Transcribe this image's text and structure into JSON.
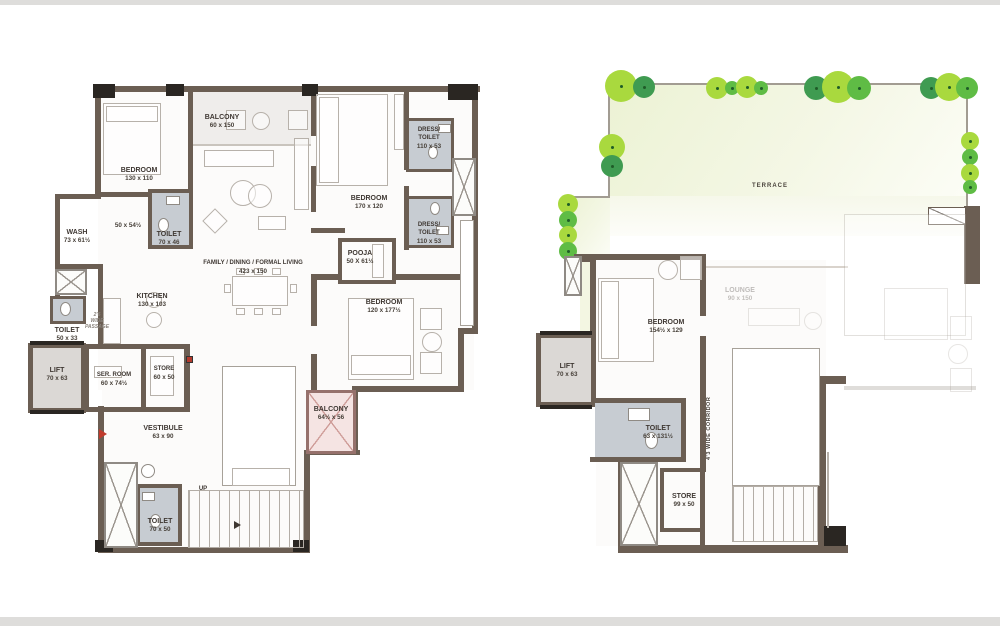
{
  "colors": {
    "wall": "#6b5e53",
    "toilet_fill": "#c7ccd2",
    "terrace_fill": "#eef3d8",
    "balcony_fill": "#f5e4e3",
    "lift_fill": "#dbd8d5",
    "tree_light": "#a9d93e",
    "tree_mid": "#5fbc45",
    "tree_dark": "#3f9b51",
    "label_text": "#3f3833",
    "entry_arrow": "#c03b2d"
  },
  "left": {
    "balcony_top": {
      "name": "BALCONY",
      "dims": "60 x 150"
    },
    "bedroom1": {
      "name": "BEDROOM",
      "dims": "130 x 110"
    },
    "bedroom2": {
      "name": "BEDROOM",
      "dims": "170 x 120"
    },
    "bedroom3": {
      "name": "BEDROOM",
      "dims": "120 x 177½"
    },
    "dress_toilet1": {
      "line1": "DRESS/",
      "line2": "TOILET",
      "dims": "110 x 53"
    },
    "dress_toilet2": {
      "line1": "DRESS/",
      "line2": "TOILET",
      "dims": "110 x 53"
    },
    "pooja": {
      "name": "POOJA",
      "dims": "50 X 61½"
    },
    "family": {
      "name": "FAMILY / DINING / FORMAL LIVING",
      "dims": "423 x 150"
    },
    "kitchen": {
      "name": "KITCHEN",
      "dims": "130 x 103"
    },
    "wash": {
      "name": "WASH",
      "dims": "73 x 61½"
    },
    "passage_dim": "50 x 54½",
    "toilet1": {
      "name": "TOILET",
      "dims": "70 x 46"
    },
    "toilet2": {
      "name": "TOILET",
      "dims": "50 x 33"
    },
    "toilet3": {
      "name": "TOILET",
      "dims": "70 x 50"
    },
    "passage_note": {
      "line1": "2'6",
      "line2": "WIDE",
      "line3": "PASSAGE"
    },
    "lift": {
      "name": "LIFT",
      "dims": "70 x 63"
    },
    "ser_room": {
      "name": "SER. ROOM",
      "dims": "60 x 74½"
    },
    "store": {
      "name": "STORE",
      "dims": "60 x 50"
    },
    "vestibule": {
      "name": "VESTIBULE",
      "dims": "63 x 90"
    },
    "balcony2": {
      "name": "BALCONY",
      "dims": "64½ x 56"
    },
    "up": "UP"
  },
  "right": {
    "terrace": "TERRACE",
    "lift": {
      "name": "LIFT",
      "dims": "70 x 63"
    },
    "bedroom": {
      "name": "BEDROOM",
      "dims": "154½ x 129"
    },
    "toilet": {
      "name": "TOILET",
      "dims": "63 x 131½"
    },
    "corridor": "4'3 WIDE CORRIDOR",
    "store": {
      "name": "STORE",
      "dims": "99 x 50"
    },
    "lounge": {
      "name": "LOUNGE",
      "dims": "90 x 150"
    }
  }
}
